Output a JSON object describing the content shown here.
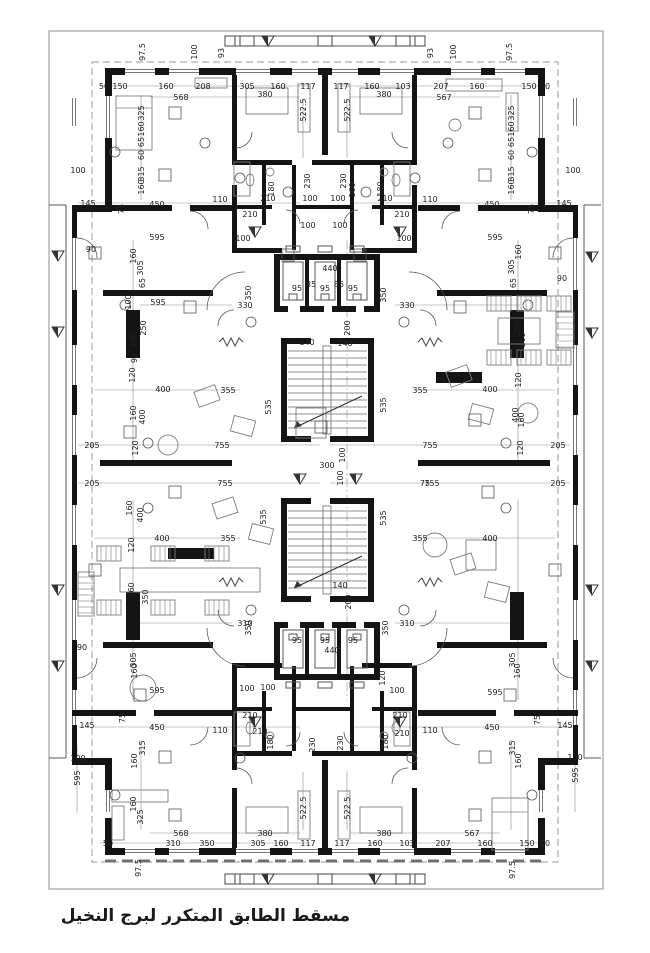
{
  "caption": "مسقط الطابق المتكرر لبرج النخيل",
  "colors": {
    "wall": "#141414",
    "thin_line": "#5a5a5a",
    "dim_text": "#222222",
    "dim_line": "#8a8a8a",
    "furniture": "#7d7d7d",
    "dashed": "#9a9a9a",
    "background": "#ffffff"
  },
  "plan": {
    "drawing_type": "architectural-floor-plan",
    "core": {
      "elevator_count_top": 3,
      "elevator_count_bottom": 3,
      "stair_flights": 2
    },
    "dimension_labels": [
      [
        "97.5",
        142,
        52,
        "v"
      ],
      [
        "100",
        194,
        52,
        "v"
      ],
      [
        "93",
        221,
        53,
        "v"
      ],
      [
        "100",
        453,
        52,
        "v"
      ],
      [
        "93",
        430,
        53,
        "v"
      ],
      [
        "97.5",
        509,
        52,
        "v"
      ],
      [
        "50",
        104,
        86,
        "h"
      ],
      [
        "150",
        120,
        86,
        "h"
      ],
      [
        "160",
        166,
        86,
        "h"
      ],
      [
        "208",
        203,
        86,
        "h"
      ],
      [
        "305",
        247,
        86,
        "h"
      ],
      [
        "160",
        278,
        86,
        "h"
      ],
      [
        "117",
        308,
        86,
        "h"
      ],
      [
        "117",
        341,
        86,
        "h"
      ],
      [
        "160",
        372,
        86,
        "h"
      ],
      [
        "103",
        403,
        86,
        "h"
      ],
      [
        "207",
        441,
        86,
        "h"
      ],
      [
        "160",
        477,
        86,
        "h"
      ],
      [
        "150",
        529,
        86,
        "h"
      ],
      [
        "50",
        545,
        86,
        "h"
      ],
      [
        "568",
        181,
        97,
        "h"
      ],
      [
        "380",
        265,
        94,
        "h"
      ],
      [
        "380",
        384,
        94,
        "h"
      ],
      [
        "567",
        444,
        97,
        "h"
      ],
      [
        "522.5",
        303,
        110,
        "v"
      ],
      [
        "522.5",
        347,
        110,
        "v"
      ],
      [
        "325",
        141,
        113,
        "v"
      ],
      [
        "160",
        141,
        129,
        "v"
      ],
      [
        "65",
        141,
        142,
        "v"
      ],
      [
        "60",
        141,
        155,
        "v"
      ],
      [
        "315",
        141,
        174,
        "v"
      ],
      [
        "160",
        141,
        187,
        "v"
      ],
      [
        "75",
        121,
        209,
        "v"
      ],
      [
        "325",
        511,
        113,
        "v"
      ],
      [
        "160",
        511,
        129,
        "v"
      ],
      [
        "65",
        511,
        142,
        "v"
      ],
      [
        "60",
        511,
        155,
        "v"
      ],
      [
        "315",
        511,
        174,
        "v"
      ],
      [
        "160",
        511,
        187,
        "v"
      ],
      [
        "75",
        531,
        209,
        "v"
      ],
      [
        "100",
        78,
        170,
        "h"
      ],
      [
        "100",
        573,
        170,
        "h"
      ],
      [
        "145",
        88,
        203,
        "h"
      ],
      [
        "450",
        157,
        204,
        "h"
      ],
      [
        "110",
        220,
        199,
        "h"
      ],
      [
        "210",
        268,
        198,
        "h"
      ],
      [
        "210",
        250,
        214,
        "h"
      ],
      [
        "100",
        310,
        198,
        "h"
      ],
      [
        "100",
        338,
        198,
        "h"
      ],
      [
        "100",
        308,
        225,
        "h"
      ],
      [
        "100",
        340,
        225,
        "h"
      ],
      [
        "100",
        243,
        238,
        "h"
      ],
      [
        "100",
        404,
        238,
        "h"
      ],
      [
        "210",
        385,
        198,
        "h"
      ],
      [
        "210",
        402,
        214,
        "h"
      ],
      [
        "110",
        430,
        199,
        "h"
      ],
      [
        "450",
        492,
        204,
        "h"
      ],
      [
        "145",
        564,
        203,
        "h"
      ],
      [
        "180",
        271,
        189,
        "v"
      ],
      [
        "230",
        307,
        181,
        "v"
      ],
      [
        "230",
        343,
        181,
        "v"
      ],
      [
        "180",
        380,
        189,
        "v"
      ],
      [
        "160",
        352,
        190,
        "v"
      ],
      [
        "90",
        91,
        249,
        "h"
      ],
      [
        "90",
        562,
        278,
        "h"
      ],
      [
        "595",
        157,
        237,
        "h"
      ],
      [
        "595",
        495,
        237,
        "h"
      ],
      [
        "160",
        133,
        256,
        "v"
      ],
      [
        "305",
        140,
        268,
        "v"
      ],
      [
        "65",
        142,
        283,
        "v"
      ],
      [
        "160",
        518,
        252,
        "v"
      ],
      [
        "305",
        511,
        267,
        "v"
      ],
      [
        "65",
        513,
        283,
        "v"
      ],
      [
        "595",
        158,
        302,
        "h"
      ],
      [
        "330",
        245,
        305,
        "h"
      ],
      [
        "330",
        407,
        305,
        "h"
      ],
      [
        "100",
        128,
        302,
        "v"
      ],
      [
        "250",
        143,
        328,
        "v"
      ],
      [
        "160",
        133,
        340,
        "v"
      ],
      [
        "93",
        134,
        358,
        "v"
      ],
      [
        "120",
        132,
        375,
        "v"
      ],
      [
        "350",
        517,
        327,
        "v"
      ],
      [
        "160",
        522,
        340,
        "v"
      ],
      [
        "120",
        518,
        380,
        "v"
      ],
      [
        "350",
        248,
        293,
        "v"
      ],
      [
        "350",
        383,
        295,
        "v"
      ],
      [
        "440",
        330,
        268,
        "h"
      ],
      [
        "95",
        297,
        288,
        "h"
      ],
      [
        "85",
        311,
        284,
        "h"
      ],
      [
        "95",
        325,
        288,
        "h"
      ],
      [
        "85",
        339,
        284,
        "h"
      ],
      [
        "95",
        353,
        288,
        "h"
      ],
      [
        "140",
        307,
        342,
        "h"
      ],
      [
        "140",
        345,
        343,
        "h"
      ],
      [
        "200",
        347,
        328,
        "v"
      ],
      [
        "355",
        228,
        390,
        "h"
      ],
      [
        "355",
        420,
        390,
        "h"
      ],
      [
        "400",
        163,
        389,
        "h"
      ],
      [
        "400",
        490,
        389,
        "h"
      ],
      [
        "535",
        268,
        407,
        "v"
      ],
      [
        "535",
        383,
        405,
        "v"
      ],
      [
        "400",
        142,
        417,
        "v"
      ],
      [
        "160",
        133,
        413,
        "v"
      ],
      [
        "400",
        515,
        415,
        "v"
      ],
      [
        "160",
        521,
        420,
        "v"
      ],
      [
        "205",
        92,
        445,
        "h"
      ],
      [
        "205",
        92,
        483,
        "h"
      ],
      [
        "755",
        222,
        445,
        "h"
      ],
      [
        "755",
        225,
        483,
        "h"
      ],
      [
        "755",
        430,
        445,
        "h"
      ],
      [
        "755",
        432,
        483,
        "h"
      ],
      [
        "205",
        558,
        445,
        "h"
      ],
      [
        "205",
        558,
        483,
        "h"
      ],
      [
        "120",
        135,
        448,
        "v"
      ],
      [
        "120",
        520,
        448,
        "v"
      ],
      [
        "300",
        327,
        465,
        "h"
      ],
      [
        "100",
        342,
        455,
        "v"
      ],
      [
        "100",
        340,
        478,
        "v"
      ],
      [
        "75",
        425,
        483,
        "h"
      ],
      [
        "400",
        162,
        538,
        "h"
      ],
      [
        "355",
        228,
        538,
        "h"
      ],
      [
        "355",
        420,
        538,
        "h"
      ],
      [
        "400",
        490,
        538,
        "h"
      ],
      [
        "160",
        129,
        508,
        "v"
      ],
      [
        "400",
        140,
        515,
        "v"
      ],
      [
        "120",
        131,
        545,
        "v"
      ],
      [
        "160",
        131,
        590,
        "v"
      ],
      [
        "350",
        145,
        597,
        "v"
      ],
      [
        "535",
        263,
        517,
        "v"
      ],
      [
        "535",
        383,
        518,
        "v"
      ],
      [
        "140",
        340,
        585,
        "h"
      ],
      [
        "200",
        348,
        602,
        "v"
      ],
      [
        "310",
        245,
        623,
        "h"
      ],
      [
        "310",
        407,
        623,
        "h"
      ],
      [
        "350",
        248,
        628,
        "v"
      ],
      [
        "350",
        385,
        628,
        "v"
      ],
      [
        "95",
        297,
        640,
        "h"
      ],
      [
        "95",
        325,
        640,
        "h"
      ],
      [
        "95",
        353,
        640,
        "h"
      ],
      [
        "440",
        332,
        650,
        "h"
      ],
      [
        "90",
        82,
        647,
        "h"
      ],
      [
        "100",
        247,
        688,
        "h"
      ],
      [
        "100",
        268,
        687,
        "h"
      ],
      [
        "100",
        397,
        690,
        "h"
      ],
      [
        "120",
        382,
        678,
        "v"
      ],
      [
        "595",
        157,
        690,
        "h"
      ],
      [
        "595",
        495,
        692,
        "h"
      ],
      [
        "305",
        133,
        660,
        "v"
      ],
      [
        "160",
        134,
        671,
        "v"
      ],
      [
        "305",
        512,
        660,
        "v"
      ],
      [
        "160",
        517,
        671,
        "v"
      ],
      [
        "145",
        87,
        725,
        "h"
      ],
      [
        "450",
        157,
        727,
        "h"
      ],
      [
        "110",
        220,
        730,
        "h"
      ],
      [
        "210",
        250,
        715,
        "h"
      ],
      [
        "210",
        260,
        731,
        "h"
      ],
      [
        "210",
        400,
        715,
        "h"
      ],
      [
        "210",
        402,
        733,
        "h"
      ],
      [
        "110",
        430,
        730,
        "h"
      ],
      [
        "450",
        492,
        727,
        "h"
      ],
      [
        "145",
        565,
        725,
        "h"
      ],
      [
        "75",
        122,
        718,
        "v"
      ],
      [
        "75",
        537,
        720,
        "v"
      ],
      [
        "180",
        270,
        742,
        "v"
      ],
      [
        "230",
        312,
        745,
        "v"
      ],
      [
        "230",
        340,
        743,
        "v"
      ],
      [
        "180",
        385,
        742,
        "v"
      ],
      [
        "315",
        142,
        748,
        "v"
      ],
      [
        "160",
        134,
        761,
        "v"
      ],
      [
        "315",
        512,
        748,
        "v"
      ],
      [
        "160",
        518,
        761,
        "v"
      ],
      [
        "100",
        78,
        758,
        "h"
      ],
      [
        "595",
        77,
        778,
        "v"
      ],
      [
        "100",
        575,
        757,
        "h"
      ],
      [
        "595",
        575,
        775,
        "v"
      ],
      [
        "325",
        140,
        817,
        "v"
      ],
      [
        "160",
        133,
        804,
        "v"
      ],
      [
        "522.5",
        303,
        808,
        "v"
      ],
      [
        "522.5",
        347,
        808,
        "v"
      ],
      [
        "568",
        181,
        833,
        "h"
      ],
      [
        "380",
        265,
        833,
        "h"
      ],
      [
        "380",
        384,
        833,
        "h"
      ],
      [
        "567",
        472,
        833,
        "h"
      ],
      [
        "50",
        108,
        843,
        "h"
      ],
      [
        "310",
        173,
        843,
        "h"
      ],
      [
        "350",
        207,
        843,
        "h"
      ],
      [
        "305",
        258,
        843,
        "h"
      ],
      [
        "160",
        281,
        843,
        "h"
      ],
      [
        "117",
        308,
        843,
        "h"
      ],
      [
        "117",
        342,
        843,
        "h"
      ],
      [
        "160",
        375,
        843,
        "h"
      ],
      [
        "103",
        407,
        843,
        "h"
      ],
      [
        "207",
        443,
        843,
        "h"
      ],
      [
        "160",
        485,
        843,
        "h"
      ],
      [
        "150",
        527,
        843,
        "h"
      ],
      [
        "50",
        545,
        843,
        "h"
      ],
      [
        "97.5",
        138,
        868,
        "v"
      ],
      [
        "97.5",
        512,
        870,
        "v"
      ]
    ]
  }
}
